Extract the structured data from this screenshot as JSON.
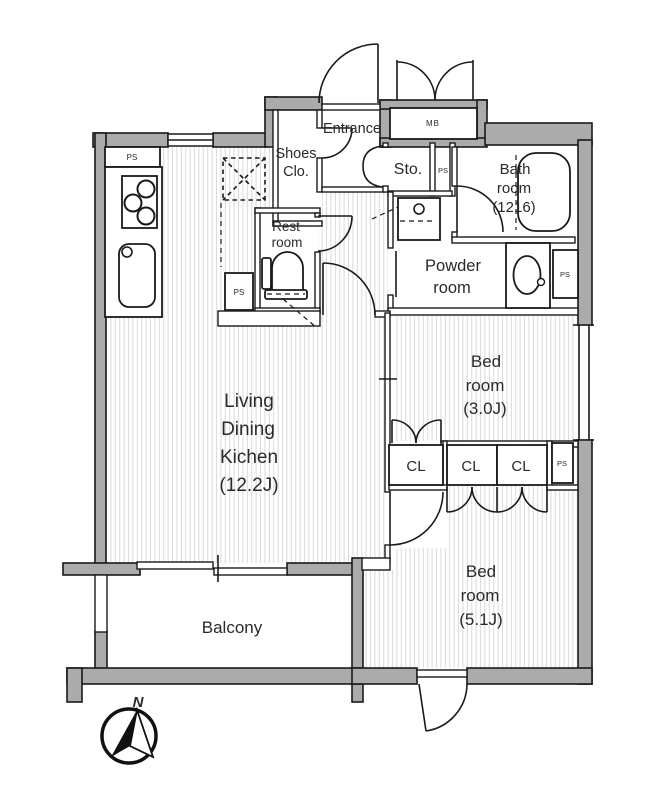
{
  "plan": {
    "labels": {
      "entrance": "Entrance",
      "shoes_closet": [
        "Shoes",
        "Clo."
      ],
      "storage": "Sto.",
      "meter_box": "MB",
      "bathroom": [
        "Bath",
        "room",
        "(1216)"
      ],
      "restroom": [
        "Rest",
        "room"
      ],
      "powder_room": [
        "Powder",
        "room"
      ],
      "ldk": [
        "Living",
        "Dining",
        "Kichen",
        "(12.2J)"
      ],
      "bedroom_3": [
        "Bed",
        "room",
        "(3.0J)"
      ],
      "bedroom_5": [
        "Bed",
        "room",
        "(5.1J)"
      ],
      "balcony": "Balcony",
      "closet": "CL",
      "pipe_space": "PS",
      "north": "N"
    },
    "colors": {
      "wall_fill": "#ababab",
      "line": "#1a1a1a",
      "floor_stripe": "#d6dadd",
      "background": "#ffffff"
    }
  }
}
